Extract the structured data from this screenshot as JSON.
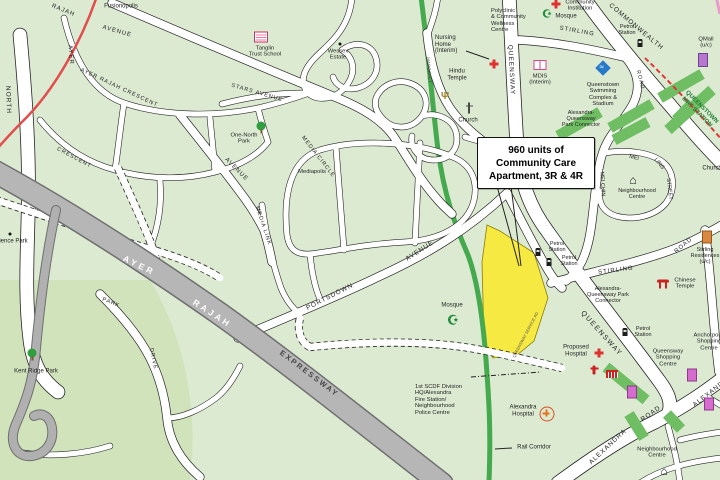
{
  "colors": {
    "land": "#dcead2",
    "park_dark": "#d0e3bb",
    "road_white": "#ffffff",
    "road_case": "#252525",
    "expressway": "#b6b6b6",
    "rail_corridor": "#45a94e",
    "park_connector": "#6fbe63",
    "site_yellow": "#f6e941",
    "mrt_red": "#e03838",
    "rail_red_line": "#e24d4d",
    "pink_line": "#eb9cc6",
    "mrt_station_text": "#1e7d32"
  },
  "callout": {
    "lines": [
      "960 units of",
      "Community Care",
      "Apartment, 3R & 4R"
    ]
  },
  "labels": [
    {
      "id": "fusionopolis",
      "text": "Fusionopolis",
      "x": 121,
      "y": 7,
      "rot": 0,
      "size": 6
    },
    {
      "id": "rajah-ave",
      "text": "RAJAH",
      "x": 63,
      "y": 11,
      "rot": 22,
      "size": 6,
      "ls": 1
    },
    {
      "id": "avenue-1",
      "text": "AVENUE",
      "x": 117,
      "y": 32,
      "rot": 16,
      "size": 6,
      "ls": 1
    },
    {
      "id": "ayer-vert",
      "text": "AYER",
      "x": 70,
      "y": 55,
      "rot": 85,
      "size": 6,
      "ls": 1
    },
    {
      "id": "ayer-rajah-crescent",
      "text": "AYER  RAJAH  CRESCENT",
      "x": 119,
      "y": 88,
      "rot": 25,
      "size": 5.5,
      "ls": 1
    },
    {
      "id": "crescent-2",
      "text": "CRESCENT",
      "x": 74,
      "y": 158,
      "rot": 28,
      "size": 5.5,
      "ls": 1
    },
    {
      "id": "north-vert",
      "text": "NORTH",
      "x": 8,
      "y": 100,
      "rot": 88,
      "size": 6.5,
      "ls": 1
    },
    {
      "id": "tanglin-school",
      "text": "Tanglin\nTrust School",
      "x": 265,
      "y": 52,
      "rot": 0,
      "size": 5.8
    },
    {
      "id": "wessex-estate",
      "text": "Wessex\nEstate",
      "x": 338,
      "y": 55,
      "rot": 0,
      "size": 5.8
    },
    {
      "id": "one-north-park",
      "text": "One-North\nPark",
      "x": 244,
      "y": 139,
      "rot": 0,
      "size": 5.8
    },
    {
      "id": "stars-avenue",
      "text": "STARS  AVENUE",
      "x": 257,
      "y": 93,
      "rot": 16,
      "size": 5.5,
      "ls": 1
    },
    {
      "id": "media-circle",
      "text": "MEDIA  CIRCLE",
      "x": 318,
      "y": 157,
      "rot": 52,
      "size": 5.5,
      "ls": 1
    },
    {
      "id": "mediapolis",
      "text": "Mediapolis",
      "x": 312,
      "y": 172,
      "rot": 0,
      "size": 5.8
    },
    {
      "id": "media-link",
      "text": "MEDIA  LINK",
      "x": 263,
      "y": 226,
      "rot": 72,
      "size": 5.5,
      "ls": 1
    },
    {
      "id": "avenue-2",
      "text": "AVENUE",
      "x": 236,
      "y": 170,
      "rot": 45,
      "size": 6,
      "ls": 1
    },
    {
      "id": "margaret",
      "text": "MARGARET",
      "x": 429,
      "y": 70,
      "rot": 85,
      "size": 4.5,
      "color": "#444"
    },
    {
      "id": "nursing-home",
      "text": "Nursing\nHome\n(Interim)",
      "x": 435,
      "y": 45,
      "rot": 0,
      "size": 6,
      "align": "left"
    },
    {
      "id": "hindu-temple",
      "text": "Hindu\nTemple",
      "x": 457,
      "y": 75,
      "rot": 0,
      "size": 6
    },
    {
      "id": "church-1",
      "text": "Church",
      "x": 468,
      "y": 121,
      "rot": 0,
      "size": 6
    },
    {
      "id": "polyclinic",
      "text": "Polyclinic\n& Community\nWellness\nCentre",
      "x": 491,
      "y": 21,
      "rot": 0,
      "size": 5.8,
      "align": "left"
    },
    {
      "id": "mosque-1",
      "text": "Mosque",
      "x": 566,
      "y": 17,
      "rot": 0,
      "size": 6
    },
    {
      "id": "community-institution",
      "text": "Community\nInstitution",
      "x": 580,
      "y": 6,
      "rot": 0,
      "size": 5.8
    },
    {
      "id": "commonwealth",
      "text": "COMMONWEALTH",
      "x": 636,
      "y": 27,
      "rot": 40,
      "size": 6.5,
      "ls": 1
    },
    {
      "id": "stirling-1",
      "text": "STIRLING",
      "x": 577,
      "y": 32,
      "rot": 10,
      "size": 6,
      "ls": 1
    },
    {
      "id": "petrol-1",
      "text": "Petrol\nStation",
      "x": 627,
      "y": 30,
      "rot": 0,
      "size": 5.5
    },
    {
      "id": "qmall",
      "text": "QMall\n(u/c)",
      "x": 706,
      "y": 43,
      "rot": 0,
      "size": 5.8
    },
    {
      "id": "queensway-vert",
      "text": "QUEENSWAY",
      "x": 511,
      "y": 70,
      "rot": 87,
      "size": 6.5,
      "ls": 1
    },
    {
      "id": "qtown-mrt",
      "text": "QUEENSTOWN\nMRT STATION",
      "x": 699,
      "y": 110,
      "rot": 45,
      "size": 6,
      "weight": "bold",
      "color": "#1e7d32"
    },
    {
      "id": "swimming",
      "text": "Queenstown\nSwimming\nComplex &\nStadium",
      "x": 603,
      "y": 95,
      "rot": 0,
      "size": 5.8
    },
    {
      "id": "mdis",
      "text": "MDIS\n(Interim)",
      "x": 540,
      "y": 80,
      "rot": 0,
      "size": 5.8
    },
    {
      "id": "aq-connector-1",
      "text": "Alexandra-\nQueensway\nPark Connector",
      "x": 581,
      "y": 119,
      "rot": 0,
      "size": 5.5
    },
    {
      "id": "road-stirling-vert",
      "text": "ROAD",
      "x": 640,
      "y": 80,
      "rot": 75,
      "size": 5.5,
      "ls": 1
    },
    {
      "id": "mei",
      "text": "MEI",
      "x": 634,
      "y": 158,
      "rot": 15,
      "size": 5.5
    },
    {
      "id": "ling",
      "text": "LING",
      "x": 659,
      "y": 164,
      "rot": 50,
      "size": 5.5
    },
    {
      "id": "street",
      "text": "STREET",
      "x": 669,
      "y": 189,
      "rot": 83,
      "size": 5.5
    },
    {
      "id": "mei-chin",
      "text": "MEI CHIN",
      "x": 602,
      "y": 184,
      "rot": 87,
      "size": 5.5
    },
    {
      "id": "nbhd-centre-1",
      "text": "Neighbourhood\nCentre",
      "x": 637,
      "y": 194,
      "rot": 0,
      "size": 5.5
    },
    {
      "id": "church-2",
      "text": "Church",
      "x": 712,
      "y": 169,
      "rot": 0,
      "size": 6
    },
    {
      "id": "stirling-2",
      "text": "STIRLING",
      "x": 616,
      "y": 271,
      "rot": -7,
      "size": 6,
      "ls": 1
    },
    {
      "id": "road-ne",
      "text": "ROAD",
      "x": 684,
      "y": 246,
      "rot": -40,
      "size": 6,
      "ls": 1
    },
    {
      "id": "stirling-res",
      "text": "Stirling\nResidences\n(u/c)",
      "x": 705,
      "y": 256,
      "rot": 0,
      "size": 5.5
    },
    {
      "id": "chinese-temple",
      "text": "Chinese\nTemple",
      "x": 685,
      "y": 284,
      "rot": 0,
      "size": 5.8
    },
    {
      "id": "aq-connector-2",
      "text": "Alexandra-\nQueensway Park\nConnector",
      "x": 608,
      "y": 295,
      "rot": 0,
      "size": 5.5
    },
    {
      "id": "petrol-2",
      "text": "Petrol\nStation",
      "x": 557,
      "y": 247,
      "rot": 0,
      "size": 5.5
    },
    {
      "id": "petrol-3",
      "text": "Petrol\nStation",
      "x": 569,
      "y": 261,
      "rot": 0,
      "size": 5.5
    },
    {
      "id": "queensway-diag",
      "text": "QUEENSWAY",
      "x": 601,
      "y": 334,
      "rot": 48,
      "size": 7,
      "ls": 1.5
    },
    {
      "id": "svc-road",
      "text": "QUEENSWAY SERVICE RD",
      "x": 526,
      "y": 335,
      "rot": -62,
      "size": 4,
      "color": "#555"
    },
    {
      "id": "mosque-2",
      "text": "Mosque",
      "x": 452,
      "y": 306,
      "rot": 0,
      "size": 6
    },
    {
      "id": "proposed-hospital",
      "text": "Proposed\nHospital",
      "x": 576,
      "y": 351,
      "rot": 0,
      "size": 6
    },
    {
      "id": "petrol-4",
      "text": "Petrol\nStation",
      "x": 643,
      "y": 332,
      "rot": 0,
      "size": 5.5
    },
    {
      "id": "qway-shopping",
      "text": "Queensway\nShopping\nCentre",
      "x": 668,
      "y": 358,
      "rot": 0,
      "size": 5.8
    },
    {
      "id": "anchorpoint",
      "text": "Anchorpoint\nShopping\nCentre",
      "x": 709,
      "y": 342,
      "rot": 0,
      "size": 5.8
    },
    {
      "id": "scdf",
      "text": "1st SCDF Division\nHQ/Alexandra\nFire Station/\nNeighbourhood\nPolice Centre",
      "x": 415,
      "y": 400,
      "rot": 0,
      "size": 5.8,
      "align": "left"
    },
    {
      "id": "alexandra-hospital",
      "text": "Alexandra\nHospital",
      "x": 523,
      "y": 411,
      "rot": 0,
      "size": 6
    },
    {
      "id": "rail-corridor",
      "text": "Rail Corridor",
      "x": 534,
      "y": 448,
      "rot": 0,
      "size": 6
    },
    {
      "id": "alexandra-1",
      "text": "ALEXANDRA",
      "x": 608,
      "y": 447,
      "rot": -43,
      "size": 6.5,
      "ls": 1
    },
    {
      "id": "road-alexandra",
      "text": "ROAD",
      "x": 651,
      "y": 414,
      "rot": -35,
      "size": 6.5,
      "ls": 1
    },
    {
      "id": "alexandra-2",
      "text": "ALEXANDRA",
      "x": 713,
      "y": 391,
      "rot": -38,
      "size": 6.5,
      "ls": 1
    },
    {
      "id": "nbhd-centre-2",
      "text": "Neighbourhood\nCentre",
      "x": 657,
      "y": 453,
      "rot": 0,
      "size": 5.8
    },
    {
      "id": "kent-ridge-park",
      "text": "Kent Ridge Park",
      "x": 36,
      "y": 372,
      "rot": 0,
      "size": 6
    },
    {
      "id": "science-park",
      "text": "Science Park",
      "x": 10,
      "y": 242,
      "rot": 0,
      "size": 6
    },
    {
      "id": "park",
      "text": "PARK",
      "x": 111,
      "y": 303,
      "rot": 22,
      "size": 5.5,
      "ls": 1
    },
    {
      "id": "drive",
      "text": "DRIVE",
      "x": 153,
      "y": 359,
      "rot": 78,
      "size": 5.5,
      "ls": 1
    },
    {
      "id": "ayer-expwy",
      "text": "AYER",
      "x": 139,
      "y": 266,
      "rot": 26,
      "size": 8.5,
      "weight": "bold",
      "color": "#ffffff",
      "ls": 3
    },
    {
      "id": "rajah-expwy",
      "text": "RAJAH",
      "x": 212,
      "y": 314,
      "rot": 33,
      "size": 8.5,
      "weight": "bold",
      "color": "#ffffff",
      "ls": 3
    },
    {
      "id": "expressway",
      "text": "EXPRESSWAY",
      "x": 309,
      "y": 374,
      "rot": 37,
      "size": 7.5,
      "weight": "bold",
      "color": "#474747",
      "ls": 2
    },
    {
      "id": "portsdown",
      "text": "PORTSDOWN",
      "x": 330,
      "y": 297,
      "rot": -27,
      "size": 6.5,
      "ls": 1
    },
    {
      "id": "avenue-portsdown",
      "text": "AVENUE",
      "x": 420,
      "y": 251,
      "rot": -33,
      "size": 6.5,
      "ls": 1
    }
  ],
  "icons": [
    {
      "type": "school-icon",
      "x": 261,
      "y": 37
    },
    {
      "type": "dot-icon",
      "x": 340,
      "y": 44
    },
    {
      "type": "tree-icon",
      "x": 261,
      "y": 126
    },
    {
      "type": "tree-icon",
      "x": 32,
      "y": 353
    },
    {
      "type": "dot-icon",
      "x": 10,
      "y": 234
    },
    {
      "type": "cross-red-icon",
      "x": 556,
      "y": 4
    },
    {
      "type": "cross-red-icon",
      "x": 494,
      "y": 64
    },
    {
      "type": "cross-red-icon",
      "x": 599,
      "y": 353
    },
    {
      "type": "cross-ring-icon",
      "x": 547,
      "y": 414
    },
    {
      "type": "glyph-icon",
      "name": "mosque-icon",
      "glyph": "☪",
      "color": "#1e8c3a",
      "size": 11,
      "x": 547,
      "y": 15
    },
    {
      "type": "glyph-icon",
      "name": "mosque-icon",
      "glyph": "☪",
      "color": "#1e8c3a",
      "size": 13,
      "x": 453,
      "y": 320
    },
    {
      "type": "glyph-icon",
      "name": "hindu-temple-icon",
      "glyph": "Ψ",
      "color": "#a8842c",
      "size": 10,
      "x": 445,
      "y": 97
    },
    {
      "type": "church-cross-icon",
      "x": 469,
      "y": 108
    },
    {
      "type": "pump-icon",
      "x": 640,
      "y": 43
    },
    {
      "type": "pump-icon",
      "x": 538,
      "y": 252
    },
    {
      "type": "pump-icon",
      "x": 549,
      "y": 262
    },
    {
      "type": "pump-icon",
      "x": 625,
      "y": 332
    },
    {
      "type": "swim-icon",
      "x": 603,
      "y": 68
    },
    {
      "type": "building-purple-icon",
      "x": 703,
      "y": 60
    },
    {
      "type": "building-orange-icon",
      "x": 707,
      "y": 237
    },
    {
      "type": "temple-red-icon",
      "x": 663,
      "y": 284
    },
    {
      "type": "glyph-icon",
      "name": "house-icon",
      "glyph": "⌂",
      "color": "#111",
      "size": 12,
      "x": 633,
      "y": 180
    },
    {
      "type": "glyph-icon",
      "name": "house-icon",
      "glyph": "⌂",
      "color": "#111",
      "size": 12,
      "x": 664,
      "y": 471
    },
    {
      "type": "book-pink-icon",
      "x": 540,
      "y": 65
    },
    {
      "type": "shop-red-icon",
      "x": 612,
      "y": 374
    },
    {
      "type": "figure-red-icon",
      "x": 594,
      "y": 370
    },
    {
      "type": "building-magenta-icon",
      "x": 632,
      "y": 392
    },
    {
      "type": "building-magenta-icon",
      "x": 692,
      "y": 375
    },
    {
      "type": "building-magenta-icon",
      "x": 709,
      "y": 404
    }
  ]
}
